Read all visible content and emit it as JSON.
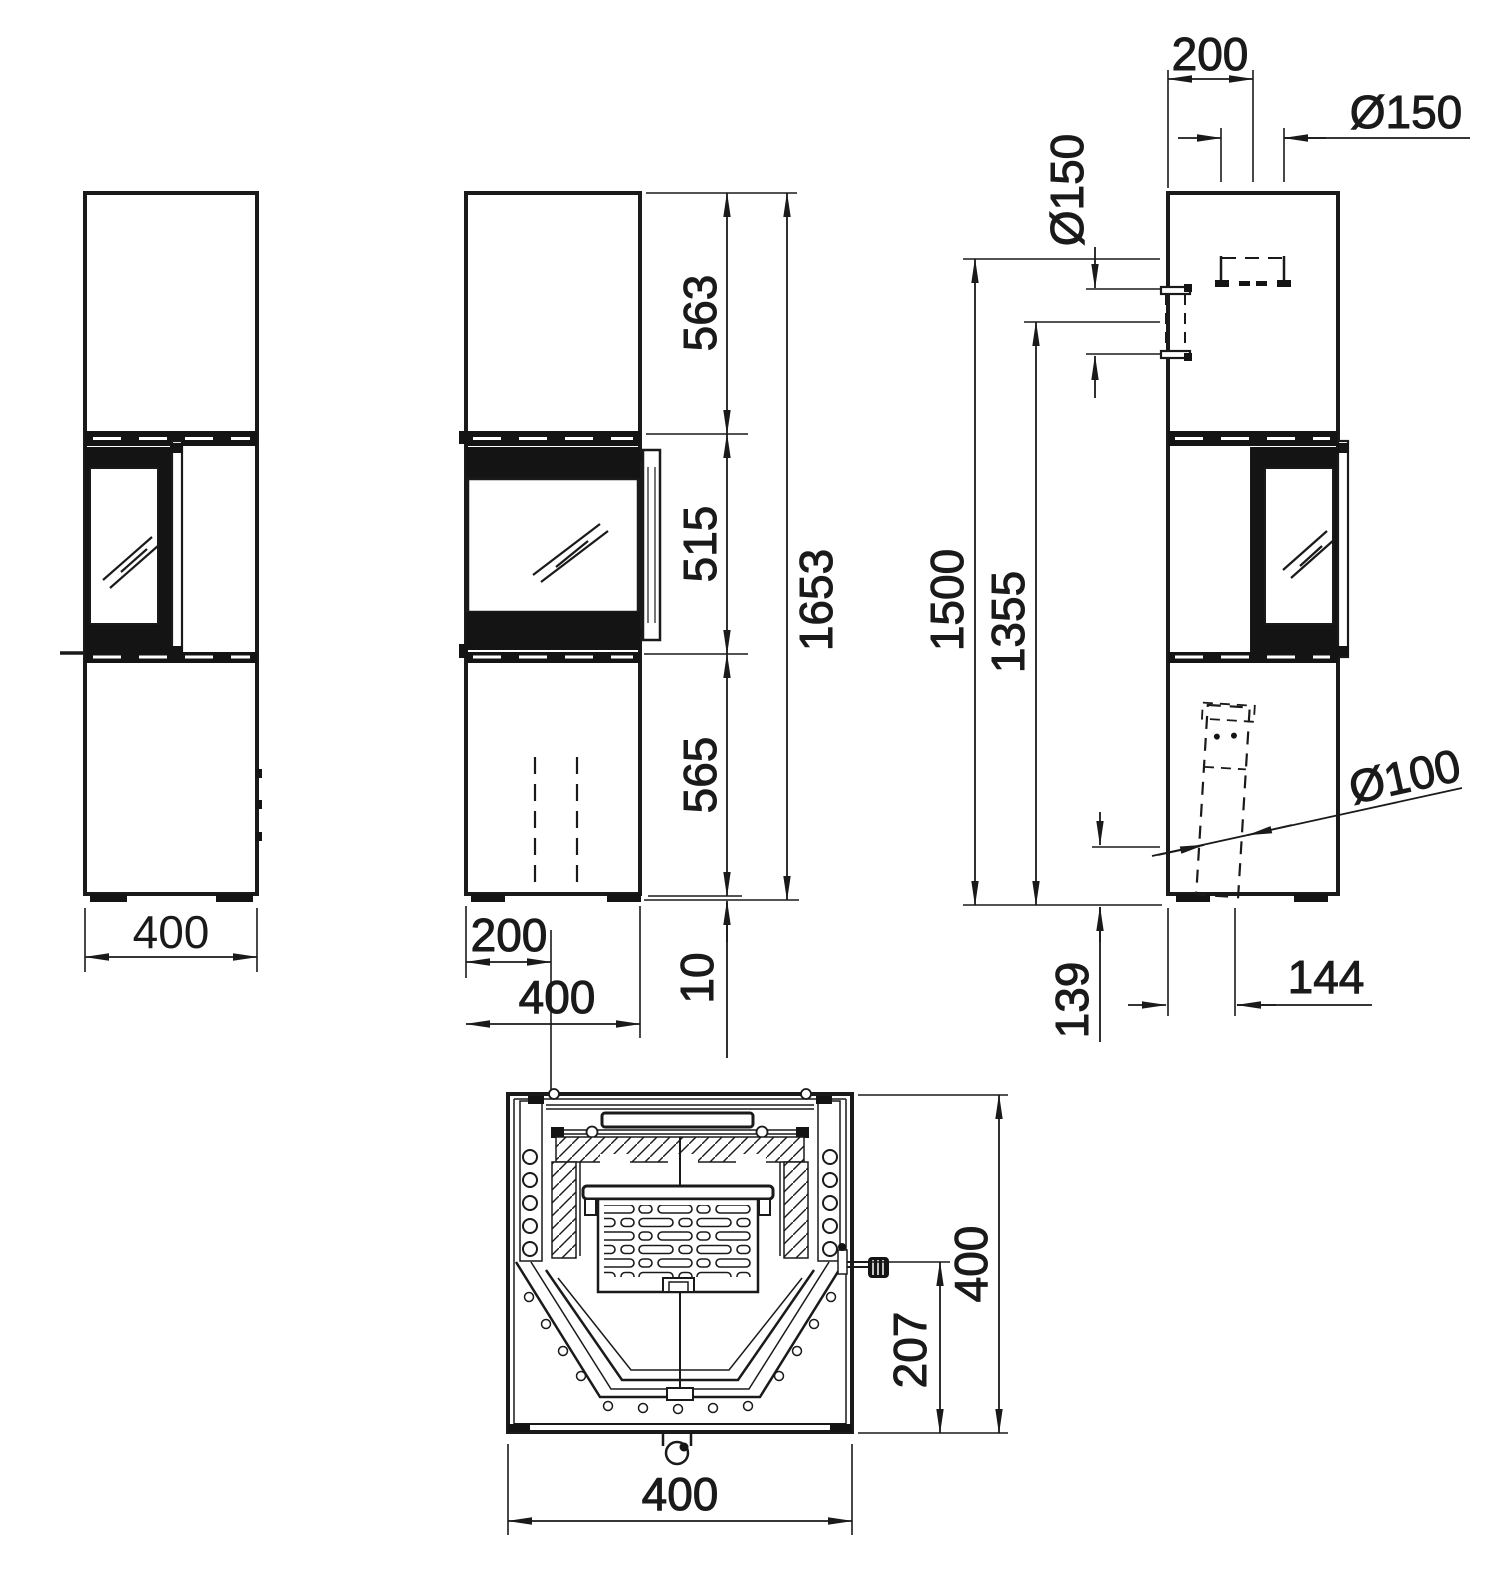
{
  "drawing": {
    "units": "mm",
    "ink_color": "#1a1a1a",
    "paper_color": "#ffffff",
    "views": {
      "left": {
        "dims": {
          "width": "400"
        }
      },
      "front": {
        "dims": {
          "top_section": "563",
          "door_section": "515",
          "base_section": "565",
          "total_height": "1653",
          "plinth": "10",
          "half_width": "200",
          "width": "400"
        }
      },
      "right": {
        "dims": {
          "flue_offset_from_back": "200",
          "top_flue_diameter": "Ø150",
          "rear_flue_diameter": "Ø150",
          "rear_flue_top_height": "1500",
          "rear_flue_center_height": "1355",
          "air_inlet_diameter": "Ø100",
          "air_inlet_center_height": "139",
          "air_inlet_offset_from_back": "144"
        }
      },
      "section": {
        "dims": {
          "depth": "400",
          "handle_offset": "207",
          "width": "400"
        }
      }
    }
  }
}
